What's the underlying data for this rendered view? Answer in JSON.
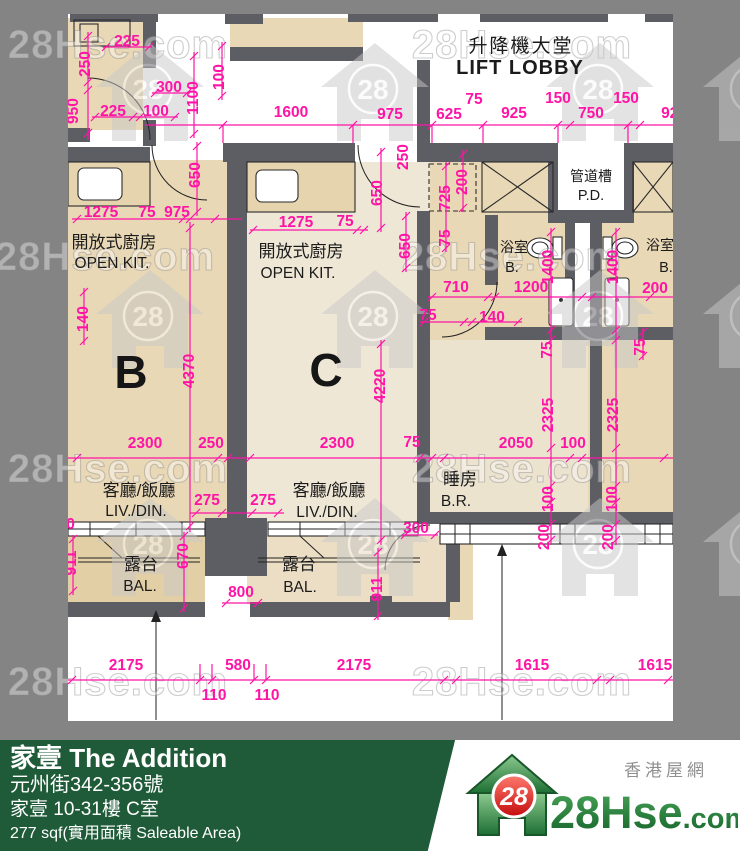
{
  "colors": {
    "background_grey": "#848484",
    "paper_white": "#ffffff",
    "wall_grey": "#5d5d64",
    "dimension_magenta": "#ff14a6",
    "room_tan": "#e9d8b6",
    "room_cream": "#efe7d5",
    "footer_green": "#1f5b38",
    "logo_green": "#1e7a34",
    "logo_red": "#d71718"
  },
  "plan": {
    "rooms": [
      {
        "t": "升降機大堂",
        "x": 521,
        "y": 52,
        "c": "cn-lg"
      },
      {
        "t": "LIFT LOBBY",
        "x": 520,
        "y": 74,
        "c": "en-lg"
      },
      {
        "t": "管道槽",
        "x": 591,
        "y": 181,
        "c": "cn-sm"
      },
      {
        "t": "P.D.",
        "x": 591,
        "y": 200,
        "c": "en-sm"
      },
      {
        "t": "開放式廚房",
        "x": 114,
        "y": 248,
        "c": "cn"
      },
      {
        "t": "OPEN KIT.",
        "x": 112,
        "y": 268,
        "c": "en"
      },
      {
        "t": "開放式廚房",
        "x": 301,
        "y": 257,
        "c": "cn"
      },
      {
        "t": "OPEN KIT.",
        "x": 298,
        "y": 278,
        "c": "en"
      },
      {
        "t": "浴室",
        "x": 514,
        "y": 252,
        "c": "cn-sm"
      },
      {
        "t": "B.",
        "x": 512,
        "y": 272,
        "c": "en-sm"
      },
      {
        "t": "浴室",
        "x": 660,
        "y": 250,
        "c": "cn-sm"
      },
      {
        "t": "B.",
        "x": 666,
        "y": 272,
        "c": "en-sm"
      },
      {
        "t": "B",
        "x": 131,
        "y": 388,
        "c": "unit"
      },
      {
        "t": "C",
        "x": 326,
        "y": 386,
        "c": "unit"
      },
      {
        "t": "客廳/飯廳",
        "x": 139,
        "y": 496,
        "c": "cn"
      },
      {
        "t": "LIV./DIN.",
        "x": 136,
        "y": 516,
        "c": "en"
      },
      {
        "t": "客廳/飯廳",
        "x": 329,
        "y": 496,
        "c": "cn"
      },
      {
        "t": "LIV./DIN.",
        "x": 327,
        "y": 517,
        "c": "en"
      },
      {
        "t": "睡房",
        "x": 460,
        "y": 485,
        "c": "cn"
      },
      {
        "t": "B.R.",
        "x": 456,
        "y": 506,
        "c": "en"
      },
      {
        "t": "露台",
        "x": 141,
        "y": 570,
        "c": "cn"
      },
      {
        "t": "BAL.",
        "x": 140,
        "y": 591,
        "c": "en"
      },
      {
        "t": "露台",
        "x": 299,
        "y": 570,
        "c": "cn"
      },
      {
        "t": "BAL.",
        "x": 300,
        "y": 592,
        "c": "en"
      }
    ],
    "dims": [
      {
        "t": "225",
        "x": 127,
        "y": 46
      },
      {
        "t": "250",
        "x": 90,
        "y": 59,
        "v": 1
      },
      {
        "t": "300",
        "x": 169,
        "y": 92
      },
      {
        "t": "1100",
        "x": 198,
        "y": 93,
        "v": 1
      },
      {
        "t": "100",
        "x": 224,
        "y": 72,
        "v": 1
      },
      {
        "t": "950",
        "x": 78,
        "y": 106,
        "v": 1
      },
      {
        "t": "225",
        "x": 113,
        "y": 116
      },
      {
        "t": "100",
        "x": 156,
        "y": 116
      },
      {
        "t": "1600",
        "x": 291,
        "y": 117
      },
      {
        "t": "975",
        "x": 390,
        "y": 119
      },
      {
        "t": "625",
        "x": 449,
        "y": 119
      },
      {
        "t": "75",
        "x": 474,
        "y": 104
      },
      {
        "t": "925",
        "x": 514,
        "y": 118
      },
      {
        "t": "150",
        "x": 558,
        "y": 103
      },
      {
        "t": "750",
        "x": 591,
        "y": 118
      },
      {
        "t": "150",
        "x": 626,
        "y": 103
      },
      {
        "t": "925",
        "x": 674,
        "y": 118
      },
      {
        "t": "650",
        "x": 200,
        "y": 170,
        "v": 1
      },
      {
        "t": "1275",
        "x": 101,
        "y": 217
      },
      {
        "t": "75",
        "x": 147,
        "y": 217
      },
      {
        "t": "975",
        "x": 177,
        "y": 217
      },
      {
        "t": "1275",
        "x": 296,
        "y": 227
      },
      {
        "t": "75",
        "x": 345,
        "y": 226
      },
      {
        "t": "250",
        "x": 408,
        "y": 152,
        "v": 1
      },
      {
        "t": "650",
        "x": 382,
        "y": 188,
        "v": 1
      },
      {
        "t": "650",
        "x": 410,
        "y": 241,
        "v": 1
      },
      {
        "t": "725",
        "x": 450,
        "y": 193,
        "v": 1
      },
      {
        "t": "200",
        "x": 467,
        "y": 177,
        "v": 1
      },
      {
        "t": "75",
        "x": 450,
        "y": 233,
        "v": 1
      },
      {
        "t": "140",
        "x": 88,
        "y": 314,
        "v": 1
      },
      {
        "t": "4370",
        "x": 194,
        "y": 366,
        "v": 1
      },
      {
        "t": "4220",
        "x": 385,
        "y": 381,
        "v": 1
      },
      {
        "t": "710",
        "x": 456,
        "y": 292
      },
      {
        "t": "1200",
        "x": 531,
        "y": 292
      },
      {
        "t": "200",
        "x": 655,
        "y": 293
      },
      {
        "t": "1400",
        "x": 553,
        "y": 262,
        "v": 1
      },
      {
        "t": "1400",
        "x": 618,
        "y": 262,
        "v": 1
      },
      {
        "t": "75",
        "x": 428,
        "y": 320
      },
      {
        "t": "140",
        "x": 492,
        "y": 322
      },
      {
        "t": "75",
        "x": 552,
        "y": 345,
        "v": 1
      },
      {
        "t": "75",
        "x": 645,
        "y": 342,
        "v": 1
      },
      {
        "t": "2325",
        "x": 553,
        "y": 410,
        "v": 1
      },
      {
        "t": "2325",
        "x": 618,
        "y": 410,
        "v": 1
      },
      {
        "t": "2300",
        "x": 145,
        "y": 448
      },
      {
        "t": "250",
        "x": 211,
        "y": 448
      },
      {
        "t": "2300",
        "x": 337,
        "y": 448
      },
      {
        "t": "75",
        "x": 412,
        "y": 447
      },
      {
        "t": "2050",
        "x": 516,
        "y": 448
      },
      {
        "t": "100",
        "x": 573,
        "y": 448
      },
      {
        "t": "2050",
        "x": 692,
        "y": 447
      },
      {
        "t": "275",
        "x": 207,
        "y": 505
      },
      {
        "t": "275",
        "x": 263,
        "y": 505
      },
      {
        "t": "300",
        "x": 62,
        "y": 529
      },
      {
        "t": "100",
        "x": 553,
        "y": 494,
        "v": 1
      },
      {
        "t": "200",
        "x": 549,
        "y": 532,
        "v": 1
      },
      {
        "t": "100",
        "x": 617,
        "y": 494,
        "v": 1
      },
      {
        "t": "200",
        "x": 613,
        "y": 532,
        "v": 1
      },
      {
        "t": "300",
        "x": 416,
        "y": 533
      },
      {
        "t": "911",
        "x": 76,
        "y": 558,
        "v": 1
      },
      {
        "t": "670",
        "x": 188,
        "y": 551,
        "v": 1
      },
      {
        "t": "800",
        "x": 241,
        "y": 597
      },
      {
        "t": "911",
        "x": 382,
        "y": 584,
        "v": 1
      },
      {
        "t": "2175",
        "x": 126,
        "y": 670
      },
      {
        "t": "580",
        "x": 238,
        "y": 670
      },
      {
        "t": "2175",
        "x": 354,
        "y": 670
      },
      {
        "t": "1615",
        "x": 532,
        "y": 670
      },
      {
        "t": "1615",
        "x": 655,
        "y": 670
      },
      {
        "t": "110",
        "x": 214,
        "y": 700
      },
      {
        "t": "110",
        "x": 267,
        "y": 700
      }
    ],
    "watermark": {
      "label": "28Hse.com",
      "badge": "28",
      "texts": [
        {
          "x": 118,
          "y": 58
        },
        {
          "x": 522,
          "y": 58
        },
        {
          "x": 105,
          "y": 270
        },
        {
          "x": 512,
          "y": 270
        },
        {
          "x": 118,
          "y": 482
        },
        {
          "x": 522,
          "y": 482
        },
        {
          "x": 118,
          "y": 695
        },
        {
          "x": 522,
          "y": 695
        }
      ],
      "houses": [
        {
          "x": 150,
          "y": 93
        },
        {
          "x": 375,
          "y": 93
        },
        {
          "x": 600,
          "y": 93
        },
        {
          "x": 150,
          "y": 320
        },
        {
          "x": 375,
          "y": 320
        },
        {
          "x": 600,
          "y": 320
        },
        {
          "x": 150,
          "y": 548
        },
        {
          "x": 375,
          "y": 548
        },
        {
          "x": 600,
          "y": 548
        },
        {
          "x": 757,
          "y": 93
        },
        {
          "x": 757,
          "y": 320
        },
        {
          "x": 757,
          "y": 548
        }
      ]
    }
  },
  "footer": {
    "title": "家壹 The Addition",
    "address": "元州街342-356號",
    "unit": "家壹 10-31樓 C室",
    "area": "277 sqf(實用面積 Saleable Area)",
    "brand": {
      "tagline": "香港屋網",
      "badge": "28",
      "site_main": "28Hse",
      "site_suffix": ".com"
    }
  }
}
